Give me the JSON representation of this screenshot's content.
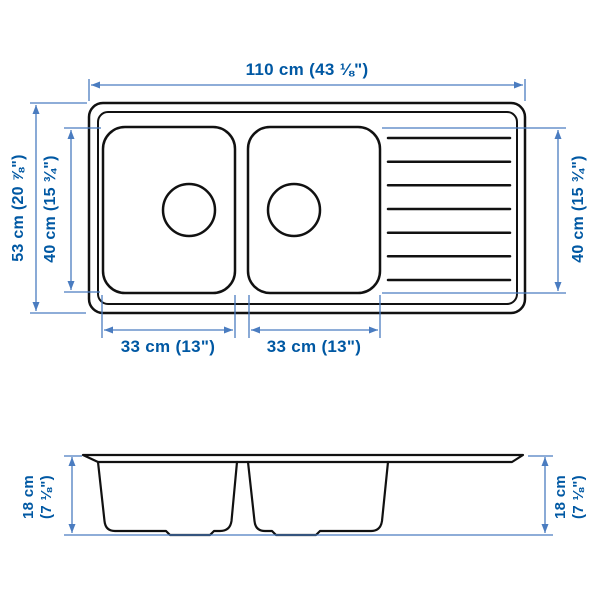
{
  "diagram": {
    "title": "double-bowl inset sink with drainboard - dimension drawing",
    "top_width_label": "110 cm (43 ⅛\")",
    "overall_depth_label": "53 cm (20 ⅞\")",
    "left_bowl_depth_label": "40 cm (15 ¾\")",
    "right_bowl_depth_label": "40 cm (15 ¾\")",
    "left_bowl_width_label": "33 cm (13\")",
    "right_bowl_width_label": "33 cm (13\")",
    "left_height_label_line1": "18 cm",
    "left_height_label_line2": "(7 ⅛\")",
    "right_height_label_line1": "18 cm",
    "right_height_label_line2": "(7 ⅛\")"
  },
  "colors": {
    "label_text": "#0058a3",
    "dimension_line": "#4a7cc0",
    "outline": "#111111",
    "background": "#ffffff"
  }
}
